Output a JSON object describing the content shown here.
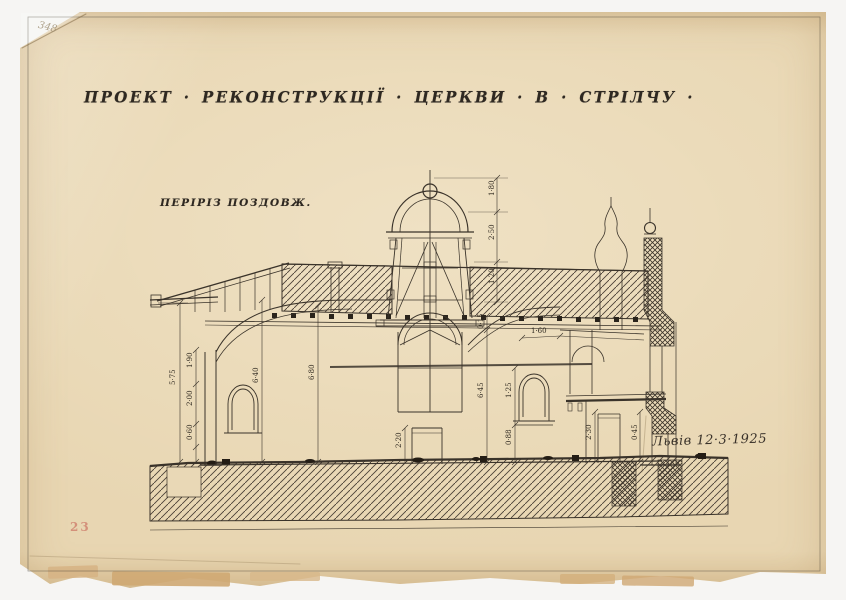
{
  "titleblock": {
    "title": "ПРОЕКТ · РЕКОНСТРУКЦІЇ · ЦЕРКВИ · В · СТРІЛЧУ ·",
    "section_label": "ПЕРІРІЗ ПОЗДОВЖ.",
    "signature": "Львів 12·3·1925"
  },
  "annotations": {
    "pencil_number": "348",
    "stamp_number": "23"
  },
  "dims": {
    "d0": "5·75",
    "d1": "1·90",
    "d2": "2·00",
    "d3": "0·60",
    "d4": "6·40",
    "d5": "6·80",
    "d6": "1·80",
    "d7": "2·50",
    "d8": "1·20",
    "d9": "0·15",
    "d10": "6·45",
    "d11": "1·25",
    "d12": "0·88",
    "d13": "2·20",
    "d14": "2·30",
    "d15": "0·45",
    "d16": "1·60"
  },
  "colors": {
    "mat": "#f3f2ef",
    "paper": "#e8d6b2",
    "ink": "#2e2821",
    "stamp_red": "#c4574e",
    "pencil": "#9c8d72"
  }
}
